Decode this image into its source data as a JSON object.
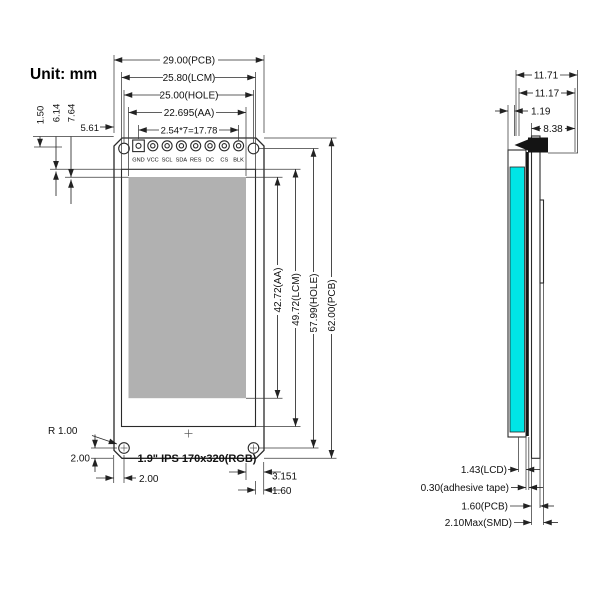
{
  "unit_label": "Unit: mm",
  "front_view": {
    "title": "1.9\" IPS 170x320(RGB)",
    "pins": [
      "GND",
      "VCC",
      "SCL",
      "SDA",
      "RES",
      "DC",
      "CS",
      "BLK"
    ],
    "width_dims": {
      "pcb": "29.00(PCB)",
      "lcm": "25.80(LCM)",
      "hole": "25.00(HOLE)",
      "aa": "22.695(AA)",
      "pin_pitch": "2.54*7=17.78"
    },
    "height_dims": {
      "aa": "42.72(AA)",
      "lcm": "49.72(LCM)",
      "hole": "57.99(HOLE)",
      "pcb": "62.00(PCB)"
    },
    "edge_dims": {
      "pin_row_offset": "1.50",
      "lcm_top_offset": "6.14",
      "aa_top_offset": "7.64",
      "pin_left_offset": "5.61",
      "corner_radius": "R 1.00",
      "hole_bottom_offset": "2.00",
      "hole_left_offset": "2.00",
      "aa_right_to_pcb": "3.151",
      "lcm_right_to_pcb": "1.60"
    }
  },
  "side_view": {
    "top_dims": [
      "11.71",
      "11.17",
      "1.19",
      "8.38"
    ],
    "layer_labels": [
      "1.43(LCD)",
      "0.30(adhesive tape)",
      "1.60(PCB)",
      "2.10Max(SMD)"
    ]
  },
  "colors": {
    "lcd_fill": "#00e5e6",
    "aa_fill": "#b1b1b1"
  }
}
